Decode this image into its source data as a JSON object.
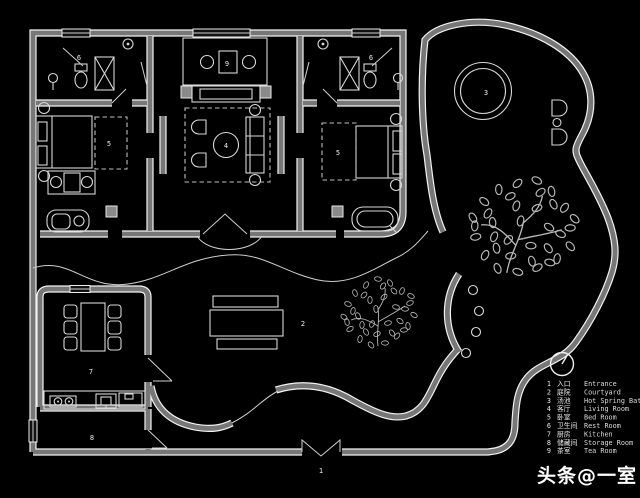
{
  "plan": {
    "labels": [
      {
        "num": "1",
        "room": "entrance"
      },
      {
        "num": "2",
        "room": "courtyard"
      },
      {
        "num": "3",
        "room": "hot-spring-bath"
      },
      {
        "num": "4",
        "room": "living-room"
      },
      {
        "num": "5",
        "room": "bed-room-left"
      },
      {
        "num": "5",
        "room": "bed-room-right"
      },
      {
        "num": "6",
        "room": "rest-room-left"
      },
      {
        "num": "6",
        "room": "rest-room-right"
      },
      {
        "num": "7",
        "room": "kitchen"
      },
      {
        "num": "8",
        "room": "storage-room"
      },
      {
        "num": "9",
        "room": "tea-room"
      }
    ]
  },
  "legend": {
    "items": [
      {
        "num": "1",
        "zh": "入口",
        "en": "Entrance"
      },
      {
        "num": "2",
        "zh": "庭院",
        "en": "Courtyard"
      },
      {
        "num": "3",
        "zh": "汤池",
        "en": "Hot Spring Bath"
      },
      {
        "num": "4",
        "zh": "客厅",
        "en": "Living Room"
      },
      {
        "num": "5",
        "zh": "卧室",
        "en": "Bed Room"
      },
      {
        "num": "6",
        "zh": "卫生间",
        "en": "Rest Room"
      },
      {
        "num": "7",
        "zh": "厨房",
        "en": "Kitchen"
      },
      {
        "num": "8",
        "zh": "储藏间",
        "en": "Storage Room"
      },
      {
        "num": "9",
        "zh": "茶室",
        "en": "Tea Room"
      }
    ]
  },
  "watermark": {
    "text": "头条@一室"
  },
  "colors": {
    "background": "#000000",
    "wall": "#777777",
    "line": "#f2f2f2"
  }
}
